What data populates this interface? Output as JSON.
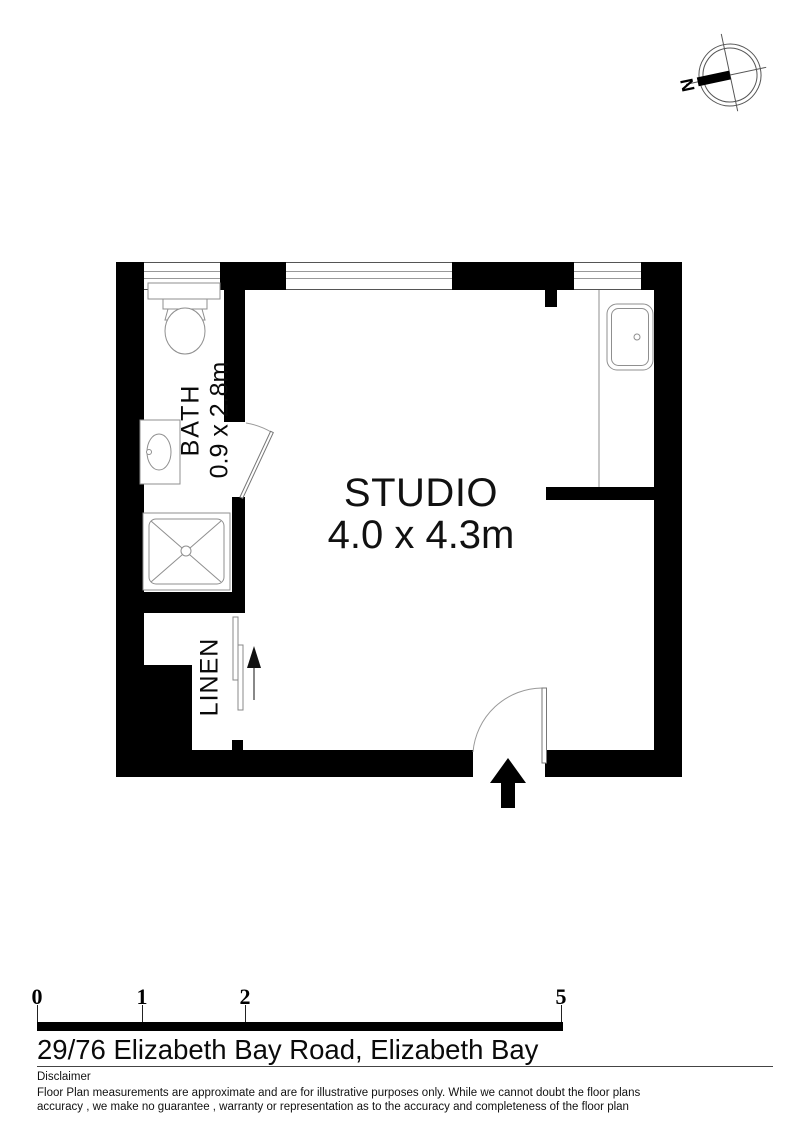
{
  "address": "29/76 Elizabeth Bay Road, Elizabeth Bay",
  "plan": {
    "rooms": [
      {
        "id": "studio",
        "name": "STUDIO",
        "dimensions": "4.0 x 4.3m"
      },
      {
        "id": "bath",
        "name": "BATH",
        "dimensions": "0.9 x 2.8m"
      },
      {
        "id": "linen",
        "name": "LINEN"
      }
    ],
    "compass": {
      "north_label": "N"
    }
  },
  "scale_bar": {
    "tick_labels": [
      "0",
      "1",
      "2",
      "5"
    ],
    "units": "m"
  },
  "disclaimer": {
    "heading": "Disclaimer",
    "line1": "Floor Plan measurements are approximate and are for illustrative purposes only. While we cannot doubt the floor plans",
    "line2": "accuracy , we make no guarantee , warranty or representation as to the accuracy and completeness of the floor plan"
  },
  "colors": {
    "wall": "#000000",
    "fixture_line": "#8f8f8f",
    "background": "#ffffff"
  }
}
